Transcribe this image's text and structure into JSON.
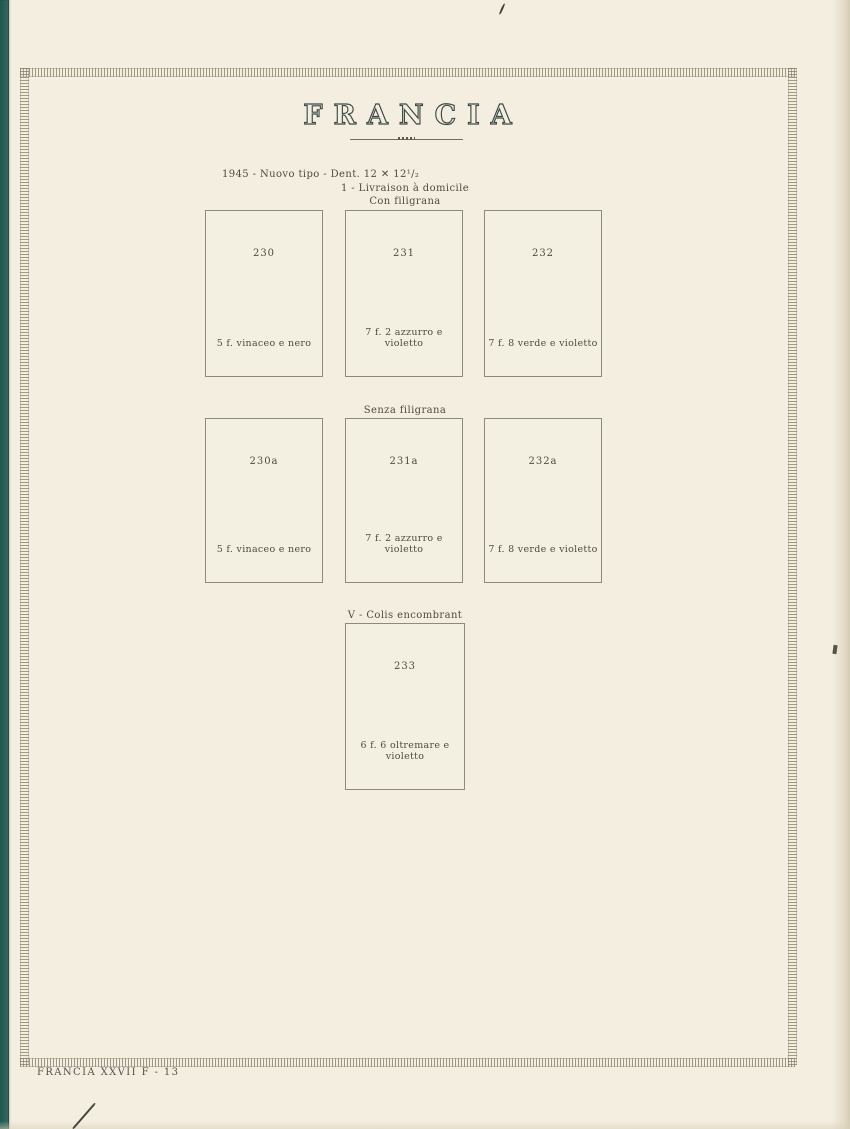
{
  "page": {
    "title": "FRANCIA",
    "issue_line": "1945 - Nuovo tipo - Dent. 12 ✕ 12¹/₂",
    "footer": "FRANCIA XXVII F - 13",
    "paper_color": "#f3eedf",
    "spine_color": "#2a6159",
    "ink_color": "#4e4b40",
    "title_color": "#3e4a45"
  },
  "sections": [
    {
      "heading_line1": "1 - Livraison à domicile",
      "heading_line2": "Con filigrana",
      "boxes": [
        {
          "number": "230",
          "label": "5 f. vinaceo e nero"
        },
        {
          "number": "231",
          "label": "7 f. 2 azzurro e violetto"
        },
        {
          "number": "232",
          "label": "7 f. 8 verde e violetto"
        }
      ]
    },
    {
      "heading_line1": "Senza filigrana",
      "boxes": [
        {
          "number": "230a",
          "label": "5 f. vinaceo e nero"
        },
        {
          "number": "231a",
          "label": "7 f. 2 azzurro e violetto"
        },
        {
          "number": "232a",
          "label": "7 f. 8 verde e violetto"
        }
      ]
    },
    {
      "heading_line1": "V - Colis encombrant",
      "boxes": [
        {
          "number": "233",
          "label": "6 f. 6 oltremare e violetto"
        }
      ]
    }
  ]
}
